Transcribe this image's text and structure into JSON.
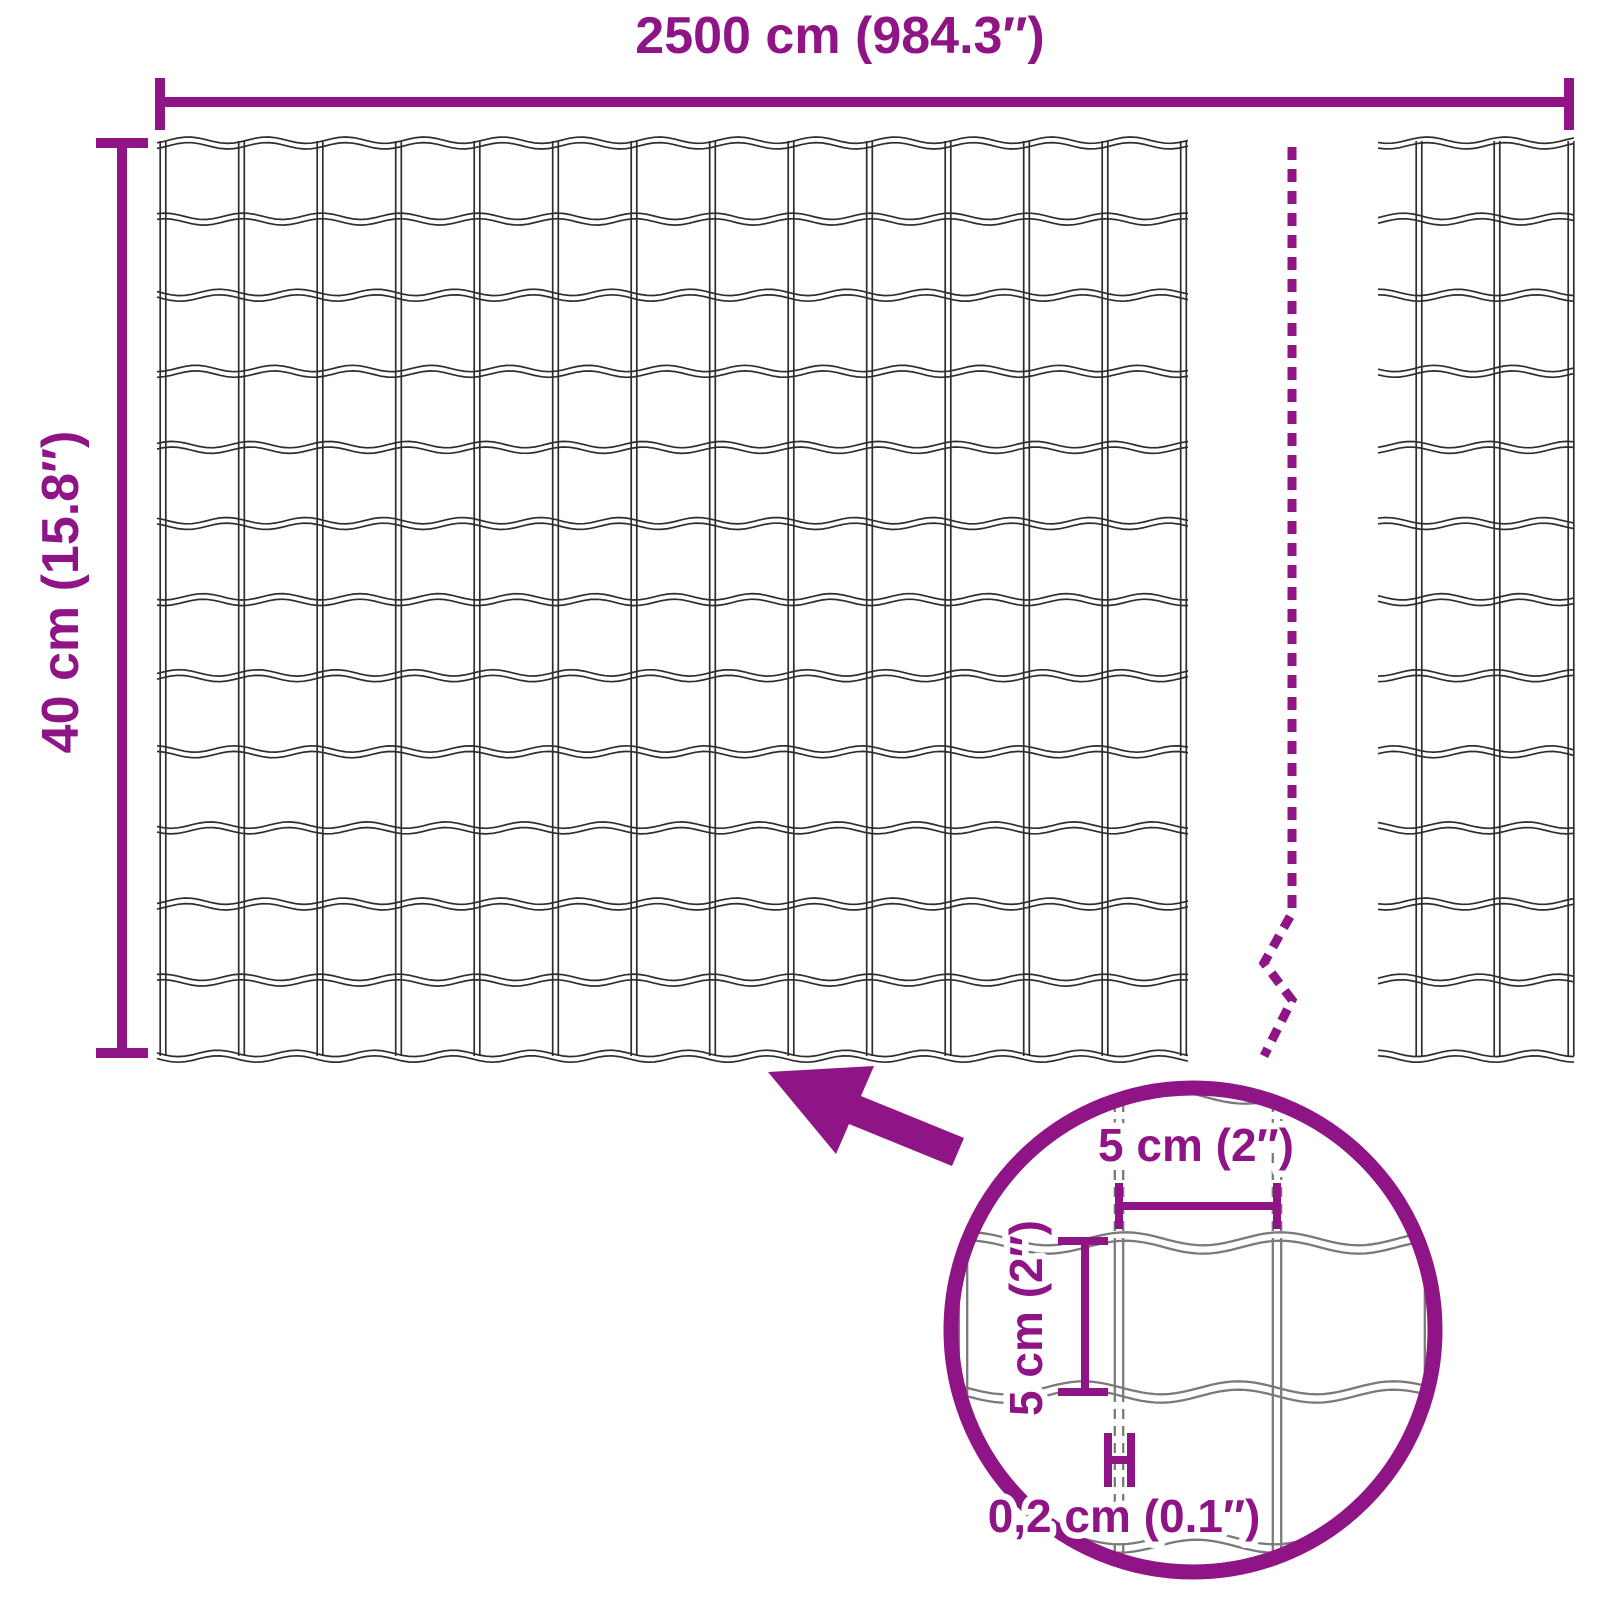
{
  "diagram": {
    "title_hint": "wire mesh fence roll dimensions",
    "width_label": "2500 cm (984.3″)",
    "height_label": "40 cm (15.8″)",
    "detail": {
      "mesh_width_label": "5 cm (2″)",
      "mesh_height_label": "5 cm (2″)",
      "wire_thickness_label": "0,2 cm (0.1″)"
    },
    "mesh": {
      "main_panel": {
        "rows": 12,
        "columns": 13
      },
      "partial_panel": {
        "rows": 12,
        "visible_columns": 2
      }
    },
    "colors": {
      "accent": "#8F1486",
      "wire_outline": "#2e2e2e",
      "detail_wire": "#7a7a7a"
    }
  }
}
